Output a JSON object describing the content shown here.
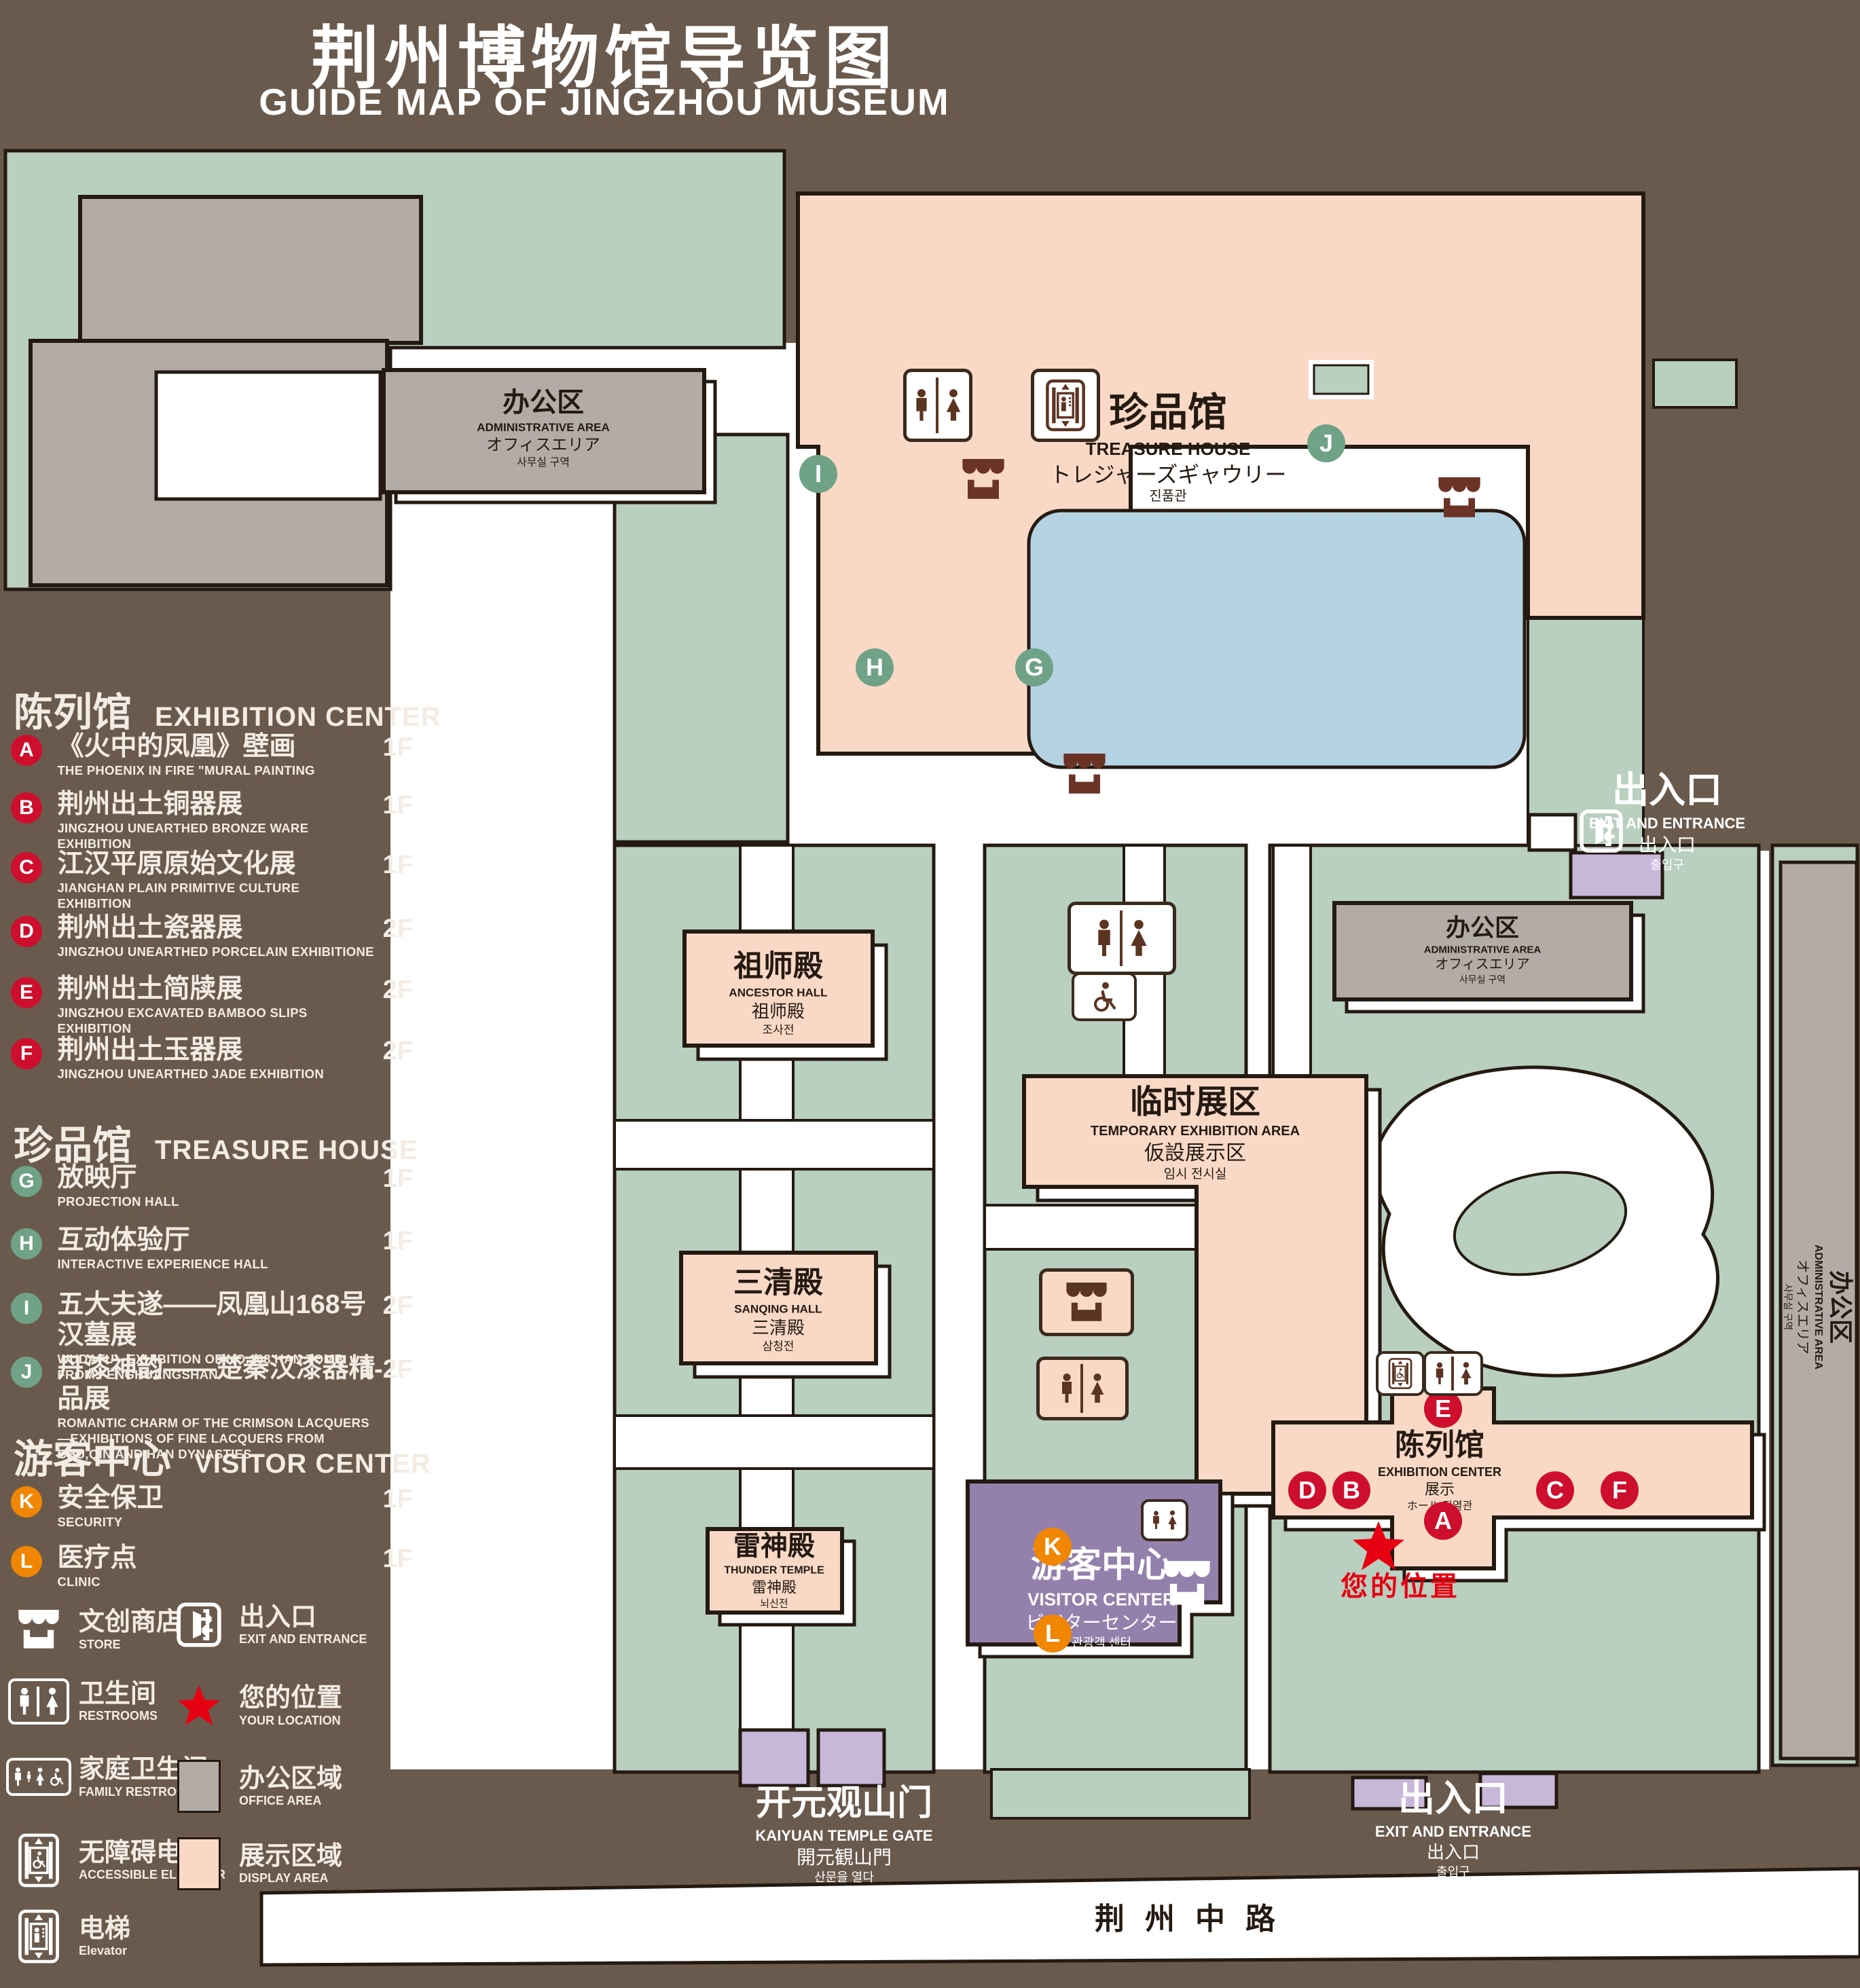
{
  "title": {
    "zh": "荆州博物馆导览图",
    "en": "GUIDE MAP OF JINGZHOU MUSEUM"
  },
  "legend": {
    "sections": [
      {
        "title_zh": "陈列馆",
        "title_en": "EXHIBITION CENTER",
        "badge_color": "#ce0e2d",
        "items": [
          {
            "key": "A",
            "zh": "《火中的凤凰》壁画",
            "en": "THE PHOENIX IN FIRE \"MURAL PAINTING",
            "floor": "1F"
          },
          {
            "key": "B",
            "zh": "荆州出土铜器展",
            "en": "JINGZHOU UNEARTHED BRONZE WARE EXHIBITION",
            "floor": "1F"
          },
          {
            "key": "C",
            "zh": "江汉平原原始文化展",
            "en": "JIANGHAN PLAIN PRIMITIVE CULTURE EXHIBITION",
            "floor": "1F"
          },
          {
            "key": "D",
            "zh": "荆州出土瓷器展",
            "en": "JINGZHOU UNEARTHED PORCELAIN EXHIBITIONE",
            "floor": "2F"
          },
          {
            "key": "E",
            "zh": "荆州出土简牍展",
            "en": "JINGZHOU EXCAVATED BAMBOO SLIPS EXHIBITION",
            "floor": "2F"
          },
          {
            "key": "F",
            "zh": "荆州出土玉器展",
            "en": "JINGZHOU UNEARTHED JADE EXHIBITION",
            "floor": "2F"
          }
        ]
      },
      {
        "title_zh": "珍品馆",
        "title_en": "TREASURE HOUSE",
        "badge_color": "#6fa287",
        "items": [
          {
            "key": "G",
            "zh": "放映厅",
            "en": "PROJECTION HALL",
            "floor": "1F"
          },
          {
            "key": "H",
            "zh": "互动体验厅",
            "en": "INTERACTIVE EXPERIENCE HALL",
            "floor": "1F"
          },
          {
            "key": "I",
            "zh": "五大夫遂——凤凰山168号汉墓展",
            "en": "WUDAFU—EXHIBITION OF NO.168 HAN TOMB FROM FENGHUANGSHAN",
            "floor": "2F"
          },
          {
            "key": "J",
            "zh": "丹漆神韵——楚秦汉漆器精品展",
            "en": "ROMANTIC CHARM OF THE CRIMSON LACQUERS—EXHIBITIONS OF FINE LACQUERS FROM CHU,QIN AND HAN DYNASTIES",
            "floor": "1-2F"
          }
        ]
      },
      {
        "title_zh": "游客中心",
        "title_en": "VISITOR CENTER",
        "badge_color": "#f08604",
        "items": [
          {
            "key": "K",
            "zh": "安全保卫",
            "en": "SECURITY",
            "floor": "1F"
          },
          {
            "key": "L",
            "zh": "医疗点",
            "en": "CLINIC",
            "floor": "1F"
          }
        ]
      }
    ],
    "symbols": {
      "store": {
        "zh": "文创商店",
        "en": "STORE"
      },
      "exit": {
        "zh": "出入口",
        "en": "EXIT AND ENTRANCE"
      },
      "restroom": {
        "zh": "卫生间",
        "en": "RESTROOMS"
      },
      "location": {
        "zh": "您的位置",
        "en": "YOUR LOCATION"
      },
      "family": {
        "zh": "家庭卫生间",
        "en": "FAMILY RESTROOMS"
      },
      "office": {
        "zh": "办公区域",
        "en": "OFFICE AREA"
      },
      "accessible": {
        "zh": "无障碍电梯",
        "en": "ACCESSIBLE ELEVATOR"
      },
      "display": {
        "zh": "展示区域",
        "en": "DISPLAY AREA"
      },
      "elevator": {
        "zh": "电梯",
        "en": "Elevator"
      }
    }
  },
  "map": {
    "admin_nw": {
      "zh": "办公区",
      "en": "ADMINISTRATIVE AREA",
      "ja": "オフィスエリア",
      "ko": "사무실 구역"
    },
    "treasure": {
      "zh": "珍品馆",
      "en": "TREASURE HOUSE",
      "ja": "トレジャーズギャウリー",
      "ko": "진품관"
    },
    "ancestor": {
      "zh": "祖师殿",
      "en": "ANCESTOR HALL",
      "ja": "祖师殿",
      "ko": "조사전"
    },
    "temporary": {
      "zh": "临时展区",
      "en": "TEMPORARY EXHIBITION AREA",
      "ja": "仮設展示区",
      "ko": "임시 전시실"
    },
    "admin_mid": {
      "zh": "办公区",
      "en": "ADMINISTRATIVE AREA",
      "ja": "オフィスエリア",
      "ko": "사무실 구역"
    },
    "admin_east": {
      "zh": "办公区",
      "en": "ADMINISTRATIVE AREA",
      "ja": "オフィスエリア",
      "ko": "사무실 구역"
    },
    "sanqing": {
      "zh": "三清殿",
      "en": "SANQING HALL",
      "ja": "三清殿",
      "ko": "삼청전"
    },
    "thunder": {
      "zh": "雷神殿",
      "en": "THUNDER TEMPLE",
      "ja": "雷神殿",
      "ko": "뇌신전"
    },
    "visitor": {
      "zh": "游客中心",
      "en": "VISITOR CENTER",
      "ja": "ビジターセンター",
      "ko": "관광객 센터"
    },
    "exhibition": {
      "zh": "陈列馆",
      "en": "EXHIBITION CENTER",
      "ja": "展示",
      "ko": "ホール 진열관"
    },
    "exit_ne": {
      "zh": "出入口",
      "en": "EXIT AND ENTRANCE",
      "ja": "出入口",
      "ko": "출입구"
    },
    "exit_s": {
      "zh": "出入口",
      "en": "EXIT AND ENTRANCE",
      "ja": "出入口",
      "ko": "출입구"
    },
    "gate": {
      "zh": "开元观山门",
      "en": "KAIYUAN TEMPLE GATE",
      "ja": "開元観山門",
      "ko": "산문을 열다"
    },
    "road": "荆州中路",
    "your_location": "您的位置",
    "markers": {
      "red": [
        "A",
        "B",
        "C",
        "D",
        "E",
        "F"
      ],
      "green": [
        "G",
        "H",
        "I",
        "J"
      ],
      "orange": [
        "K",
        "L"
      ]
    }
  },
  "colors": {
    "background": "#6a5a4d",
    "green_area": "#b9cfc0",
    "office_area": "#b3aca6",
    "display_area": "#f9d9c6",
    "visitor_area": "#9480ac",
    "entrance_area": "#c9b7da",
    "water": "#b5d2e2",
    "marker_red": "#ce0e2d",
    "marker_green": "#6fa287",
    "marker_orange": "#f08604",
    "location_red": "#e60012"
  }
}
